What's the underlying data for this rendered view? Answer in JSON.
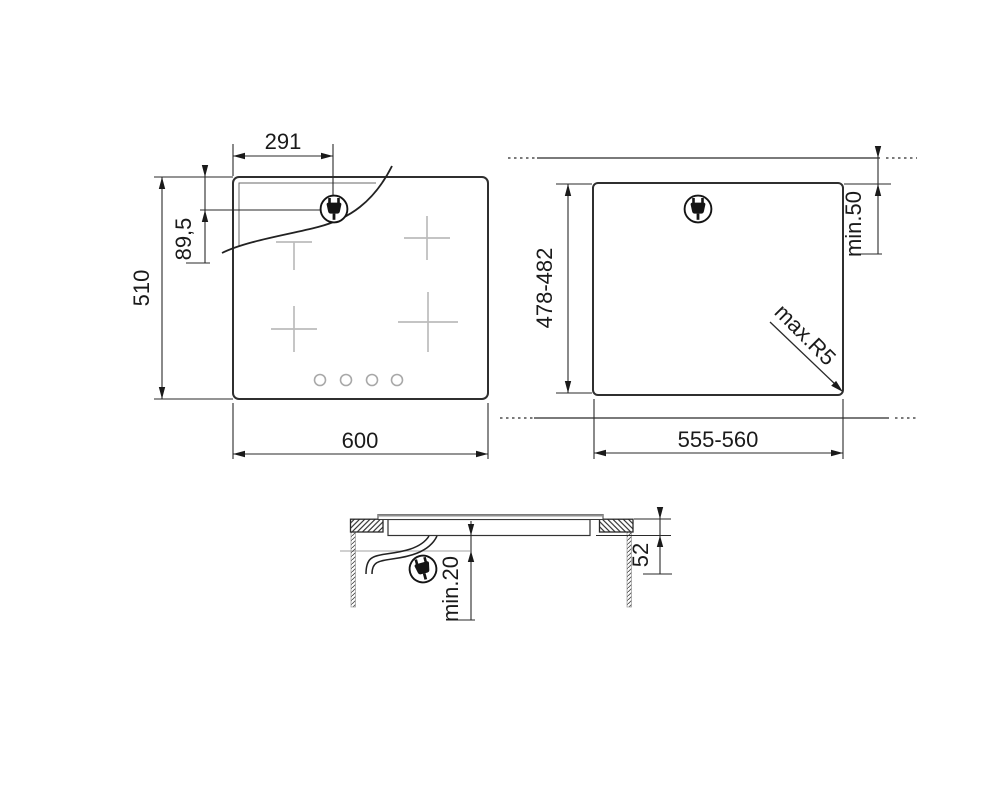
{
  "colors": {
    "ink": "#1a1a1a",
    "outline": "#2a2a2a",
    "burner_mark": "#bcbcbc",
    "knob_ring": "#a8a8a8",
    "glass_edge": "#8f8f8f",
    "reference_line": "#b5b5b5"
  },
  "icons": {
    "plug": "power-plug-icon"
  },
  "views": {
    "hob_top_view": {
      "dimensions": {
        "plug_from_left": "291",
        "plug_from_top": "89,5",
        "depth": "510",
        "width": "600"
      }
    },
    "worktop_cutout_view": {
      "dimensions": {
        "cutout_depth": "478-482",
        "rear_clearance": "min.50",
        "corner_radius": "max.R5",
        "cutout_width": "555-560"
      }
    },
    "installation_side_view": {
      "dimensions": {
        "clearance_below": "min.20",
        "built_in_depth": "52"
      }
    }
  }
}
